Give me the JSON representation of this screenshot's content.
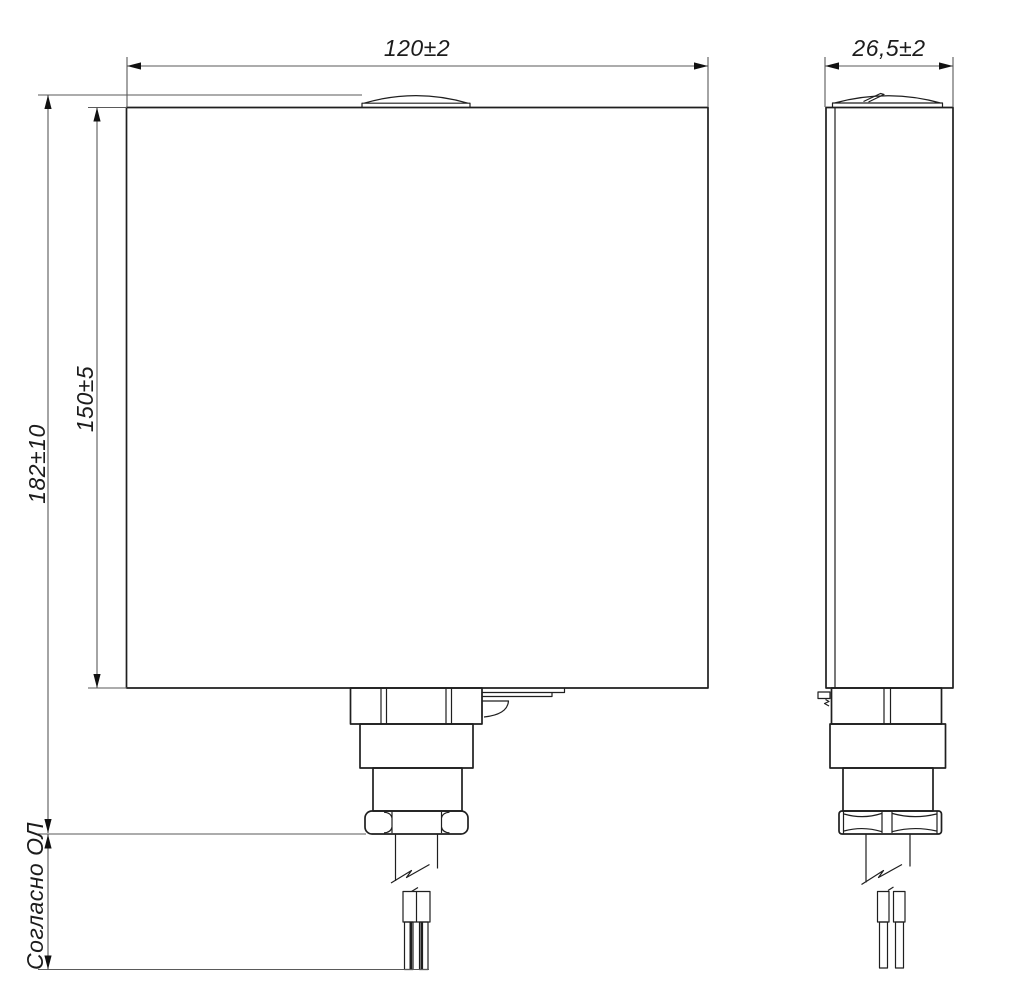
{
  "drawing": {
    "kind": "technical-dimension-drawing",
    "language": "ru",
    "dimensions": {
      "front_width": "120±2",
      "side_width": "26,5±2",
      "overall_height": "182±10",
      "body_height": "150±5",
      "cable_note": "Согласно ОЛ"
    },
    "colors": {
      "background": "#ffffff",
      "object_line": "#1f1f1f",
      "dimension_line": "#5a5a5a",
      "arrow": "#111111",
      "text": "#1c1c1c"
    }
  }
}
